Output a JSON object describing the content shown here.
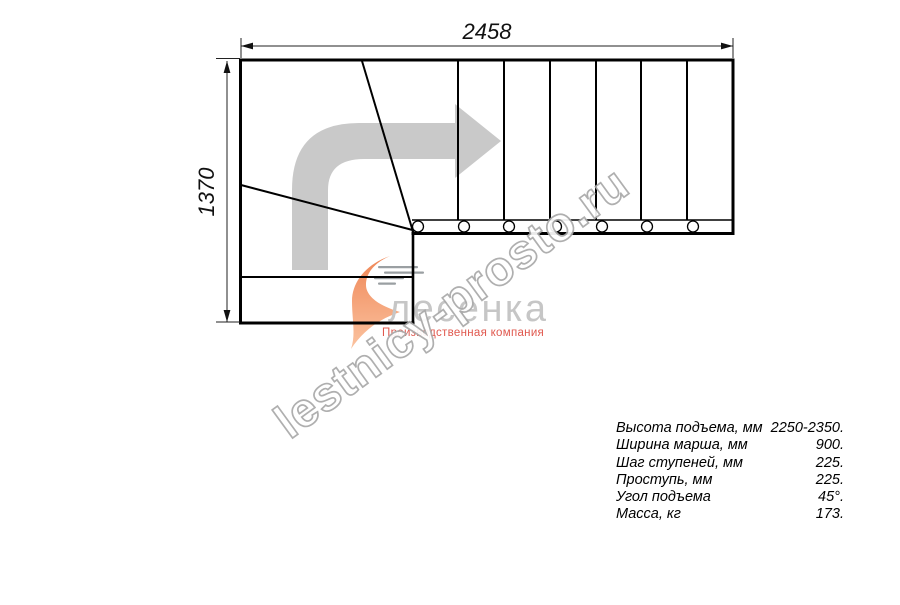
{
  "dimensions": {
    "width": "2458",
    "height": "1370"
  },
  "watermark": {
    "text": "lestnicy-prosto.ru",
    "color": "#a9a9a9"
  },
  "logo": {
    "name": "лесенка",
    "tagline": "Производственная компания",
    "colors": {
      "name_gray": "#c6c6c6",
      "tagline_red": "#e0584e",
      "swoosh_orange": "#f08a5c"
    }
  },
  "drawing": {
    "line_color": "#000000",
    "direction_arrow_color": "#c9c9c9",
    "tread_count_straight": 7,
    "baluster_count": 7
  },
  "specs": {
    "rows": [
      {
        "label": "Высота подъема, мм",
        "value": "2250-2350."
      },
      {
        "label": "Ширина марша, мм",
        "value": "900."
      },
      {
        "label": "Шаг ступеней, мм",
        "value": "225."
      },
      {
        "label": "Проступь, мм",
        "value": "225."
      },
      {
        "label": "Угол подъема",
        "value": "45°."
      },
      {
        "label": "Масса, кг",
        "value": "173."
      }
    ]
  }
}
